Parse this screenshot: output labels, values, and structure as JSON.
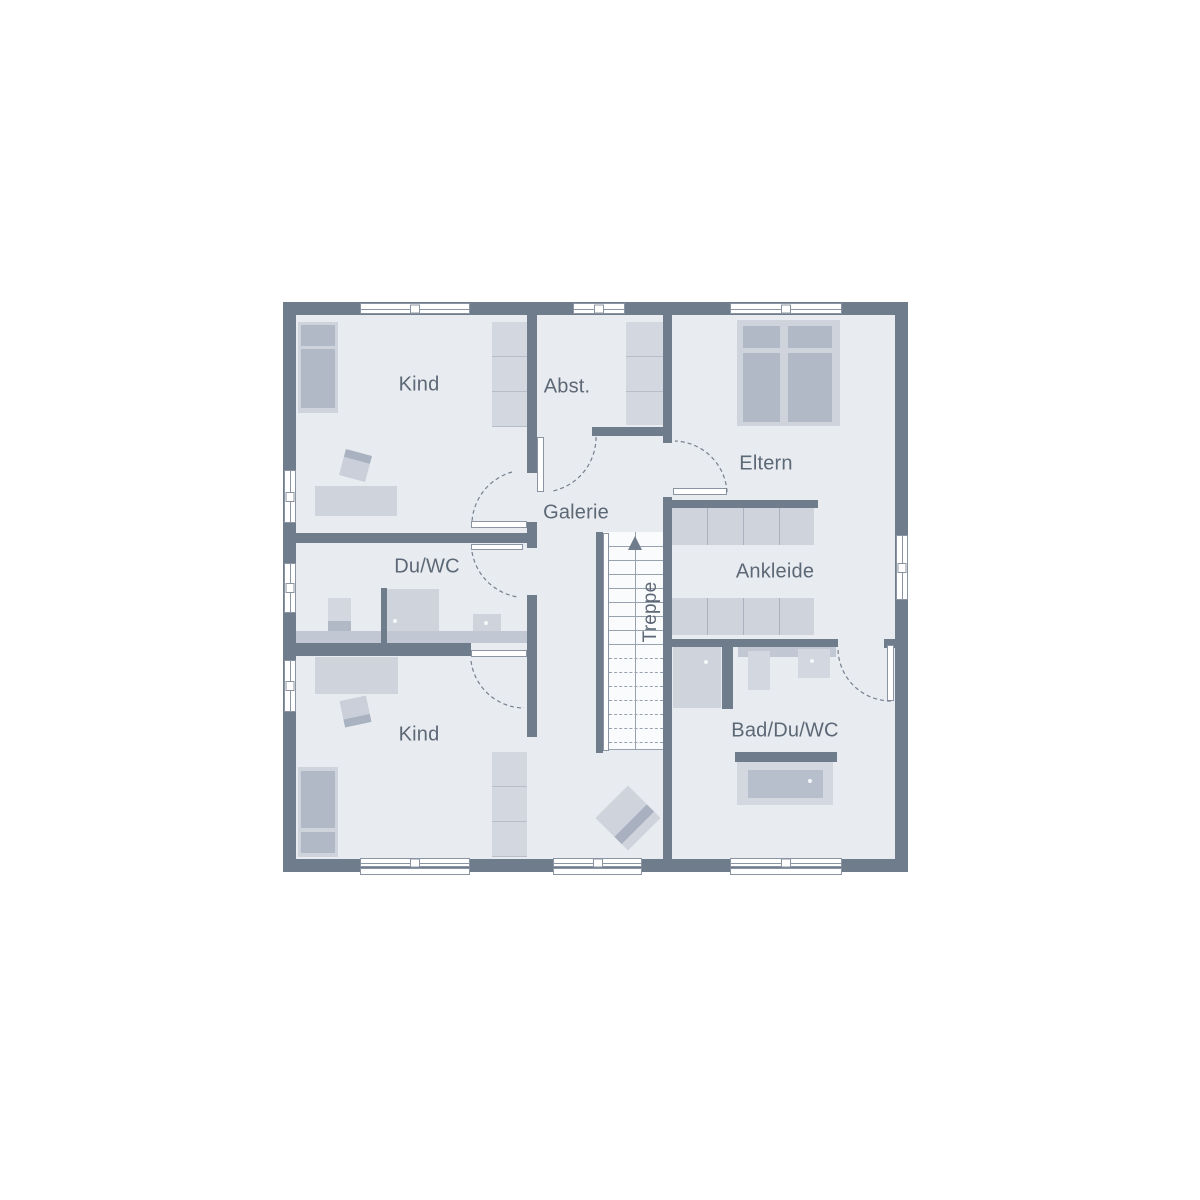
{
  "plan": {
    "type": "floorplan-upper-storey",
    "rooms": {
      "kind_top": {
        "label": "Kind"
      },
      "abst": {
        "label": "Abst."
      },
      "eltern": {
        "label": "Eltern"
      },
      "galerie": {
        "label": "Galerie"
      },
      "du_wc": {
        "label": "Du/WC"
      },
      "ankleide": {
        "label": "Ankleide"
      },
      "treppe": {
        "label": "Treppe"
      },
      "bad_du_wc": {
        "label": "Bad/Du/WC"
      },
      "kind_bottom": {
        "label": "Kind"
      }
    },
    "stairs": {
      "direction": "up",
      "treads_solid": 8,
      "treads_dashed": 7
    },
    "colors": {
      "wall": "#6f7c8c",
      "floor": "#e8ebf0",
      "furniture_light": "#d3d7e0",
      "furniture_mid": "#ced3dc",
      "furniture_dark": "#b1b9c6",
      "counter": "#c2c8d3",
      "label_text": "#5d6876",
      "window_border": "#8a94a2",
      "stair_line": "#98a1ae",
      "door_arc": "#76808e",
      "background": "#ffffff"
    }
  }
}
